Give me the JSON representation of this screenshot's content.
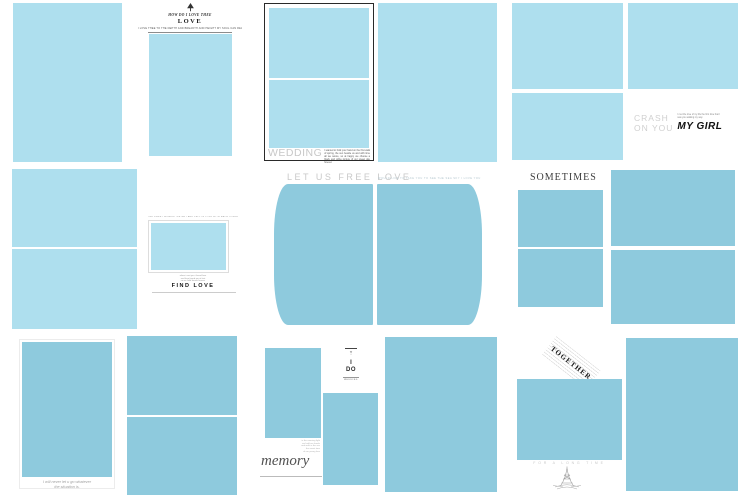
{
  "colors": {
    "photo-light": "#aedfee",
    "photo-dark": "#8ecadd",
    "title-gray": "#c8c8c8",
    "ink": "#1c1c1c",
    "muted": "#9a9a9a"
  },
  "templates": {
    "love": {
      "eyebrow": "HOW DO I LOVE THEE",
      "title": "LOVE",
      "caption": "I LOVE THEE TO THE DEPTH AND BREADTH AND HEIGHT MY SOUL CAN REACH"
    },
    "wedding": {
      "title": "WEDDING",
      "caption": "I wanted to hold your hand on the first walk of spring, the sun beside us and with time all we swore, so at happy we choose a black and white picture of our sweet day forever."
    },
    "crash": {
      "title_line1": "CRASH",
      "title_line2": "ON YOU",
      "note": "I met the love of my life the first time that I saw you walking my way",
      "subtitle": "MY GIRL"
    },
    "find_love": {
      "top_note": "THE SWEET MOMENT WE MET AND FELL IN LOVE WITH EACH OTHER",
      "note_lines": [
        "when i met you i found love",
        "and love found me at last",
        "so we hold hands forever"
      ],
      "title": "FIND LOVE"
    },
    "free_love": {
      "title": "LET US FREE LOVE",
      "note": "WOULD LIKE TO TAKE YOU TO SEE THE SEA SKY I LOVE YOU"
    },
    "sometimes": {
      "title": "SOMETIMES"
    },
    "never_let_go": {
      "caption_line1": "I will never let u go whatever",
      "caption_line2": "the situation is."
    },
    "i_do": {
      "mark": "✳",
      "mark2": "○",
      "word1": "I",
      "word2": "DO",
      "small_label": "WEDDING",
      "note_lines": [
        "in the morning light",
        "we hold our hands",
        "and walk in the sun",
        "the sweet time",
        "of our young love"
      ],
      "title": "memory"
    },
    "together": {
      "title": "TOGETHER",
      "subtitle": "FOR A LONG TIME"
    }
  }
}
